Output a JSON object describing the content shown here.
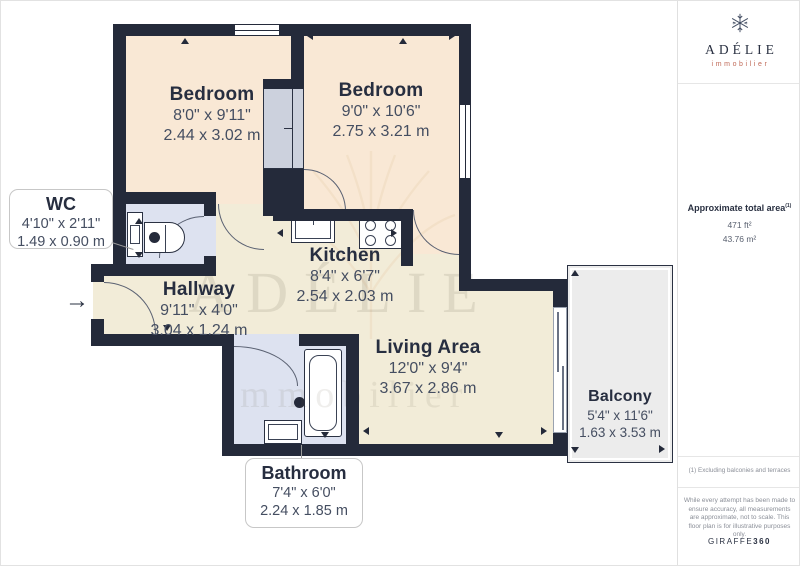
{
  "branding": {
    "logo_text": "ADÉLIE",
    "logo_subtext": "immobilier",
    "giraffe_prefix": "GIRAFFE",
    "giraffe_suffix": "360"
  },
  "sidebar": {
    "area_title": "Approximate total area",
    "area_sup": "(1)",
    "area_ft": "471 ft²",
    "area_m": "43.76 m²",
    "footnote": "(1) Excluding balconies and terraces",
    "disclaimer": "While every attempt has been made to ensure accuracy, all measurements are approximate, not to scale. This floor plan is for illustrative purposes only."
  },
  "rooms": {
    "bedroom_left": {
      "name": "Bedroom",
      "imperial": "8'0\" x 9'11\"",
      "metric": "2.44 x 3.02 m"
    },
    "bedroom_right": {
      "name": "Bedroom",
      "imperial": "9'0\" x 10'6\"",
      "metric": "2.75 x 3.21 m"
    },
    "wc": {
      "name": "WC",
      "imperial": "4'10\" x 2'11\"",
      "metric": "1.49 x 0.90 m"
    },
    "kitchen": {
      "name": "Kitchen",
      "imperial": "8'4\" x 6'7\"",
      "metric": "2.54 x 2.03 m"
    },
    "hallway": {
      "name": "Hallway",
      "imperial": "9'11\" x 4'0\"",
      "metric": "3.04 x 1.24 m"
    },
    "living": {
      "name": "Living Area",
      "imperial": "12'0\" x 9'4\"",
      "metric": "3.67 x 2.86 m"
    },
    "balcony": {
      "name": "Balcony",
      "imperial": "5'4\" x 11'6\"",
      "metric": "1.63 x 3.53 m"
    },
    "bathroom": {
      "name": "Bathroom",
      "imperial": "7'4\" x 6'0\"",
      "metric": "2.24 x 1.85 m"
    }
  },
  "watermark": {
    "line1": "ADÉLIE",
    "line2": "immobilier"
  },
  "icons": {
    "entrance_arrow": "→"
  },
  "colors": {
    "wall": "#242a3a",
    "bedroom_floor": "#f9e8d5",
    "main_floor": "#f2ecd8",
    "wet_floor": "#dde2f0",
    "balcony_floor": "#ececec",
    "accent": "#c06a58"
  }
}
